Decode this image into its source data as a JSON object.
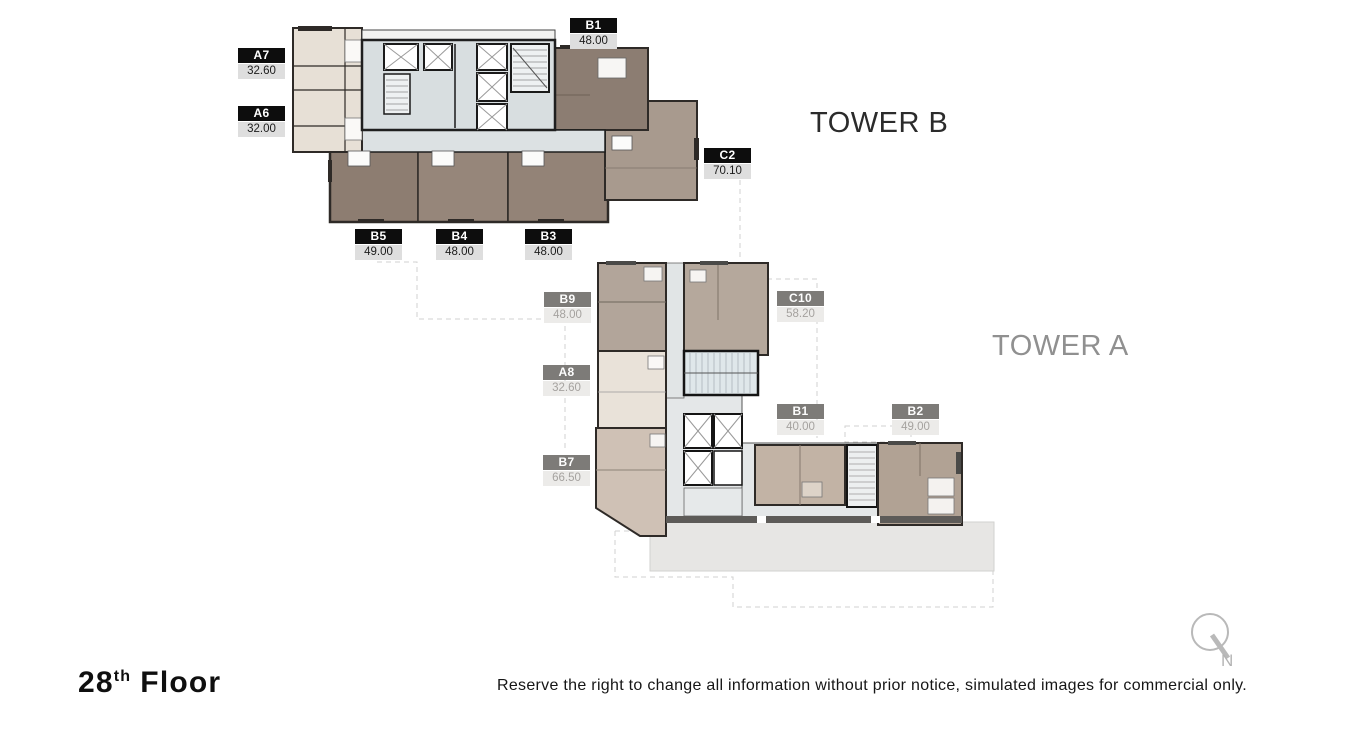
{
  "floor_label": {
    "number": "28",
    "ordinal_suffix": "th",
    "word": "Floor"
  },
  "disclaimer": "Reserve the right to change all information without prior notice, simulated images for commercial only.",
  "compass": {
    "north_label": "N"
  },
  "towers": {
    "tower_b": {
      "name": "TOWER B",
      "label_style": "black-on-white",
      "units": [
        {
          "id": "A7",
          "area": "32.60"
        },
        {
          "id": "A6",
          "area": "32.00"
        },
        {
          "id": "B1",
          "area": "48.00"
        },
        {
          "id": "C2",
          "area": "70.10"
        },
        {
          "id": "B5",
          "area": "49.00"
        },
        {
          "id": "B4",
          "area": "48.00"
        },
        {
          "id": "B3",
          "area": "48.00"
        }
      ]
    },
    "tower_a": {
      "name": "TOWER A",
      "label_style": "gray",
      "units": [
        {
          "id": "B9",
          "area": "48.00"
        },
        {
          "id": "A8",
          "area": "32.60"
        },
        {
          "id": "B7",
          "area": "66.50"
        },
        {
          "id": "C10",
          "area": "58.20"
        },
        {
          "id": "B1",
          "area": "40.00"
        },
        {
          "id": "B2",
          "area": "49.00"
        }
      ]
    }
  },
  "colors": {
    "label_black_bg": "#0d0d0d",
    "label_gray_bg": "#7d7b78",
    "area_chip_bg": "#dedede",
    "area_chip_light_bg": "#ecebe9",
    "tower_b_title": "#2b2b2b",
    "tower_a_title": "#909090",
    "unit_brown": "#8d7d71",
    "unit_taupe": "#a89a8e",
    "unit_cream": "#e7e0d6",
    "core_blue_gray": "#d8dee0",
    "podium_gray": "#e7e6e4",
    "compass_gray": "#b5b5b5"
  }
}
